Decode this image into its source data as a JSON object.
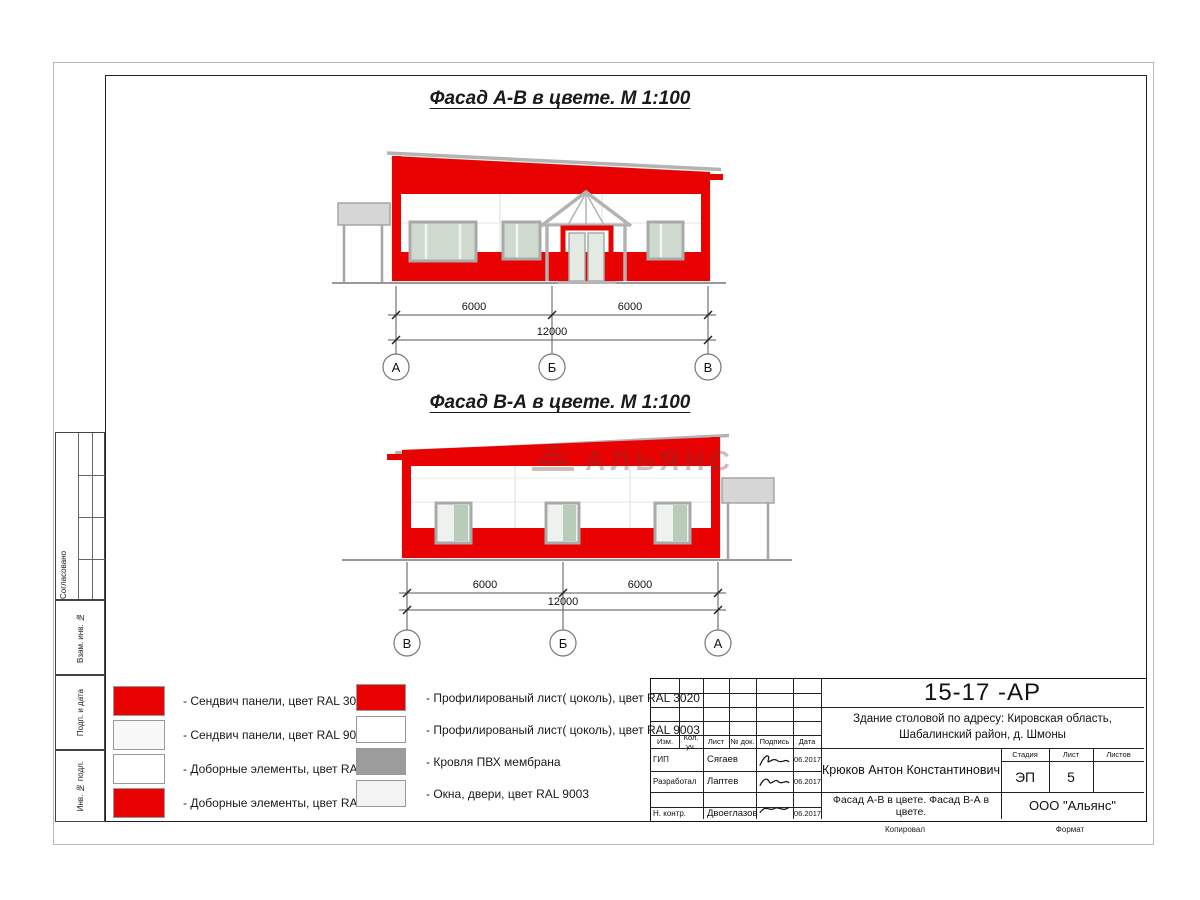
{
  "colors": {
    "ral3020": "#e80202",
    "ral9003": "#ffffff",
    "membrane": "#9c9c9c",
    "glass": "#cfdacf",
    "glass2": "#eef2ee",
    "glasstint": "#b9ccba",
    "framegray": "#a9a9a9",
    "canopy": "#d6d6d6"
  },
  "drawing": {
    "title_ab": "Фасад А-В в цвете.  М 1:100",
    "title_ba": "Фасад В-А в цвете.  М 1:100",
    "watermark": "АЛЬЯНС"
  },
  "facade_ab": {
    "dim_left": "6000",
    "dim_right": "6000",
    "dim_total": "12000",
    "axes": [
      "А",
      "Б",
      "В"
    ]
  },
  "facade_ba": {
    "dim_left": "6000",
    "dim_right": "6000",
    "dim_total": "12000",
    "axes": [
      "В",
      "Б",
      "А"
    ]
  },
  "legend": {
    "left": [
      {
        "color": "#e80202",
        "label": "- Сендвич панели, цвет RAL 3020"
      },
      {
        "color": "#f8f8f8",
        "label": "- Сендвич панели, цвет RAL 9003"
      },
      {
        "color": "#ffffff",
        "label": "- Доборные элементы, цвет RAL 9003"
      },
      {
        "color": "#e80202",
        "label": "- Доборные элементы, цвет RAL 3020"
      }
    ],
    "right": [
      {
        "color": "#e80202",
        "label": "- Профилированый лист( цоколь), цвет RAL 3020"
      },
      {
        "color": "#ffffff",
        "label": "- Профилированый лист( цоколь), цвет RAL 9003"
      },
      {
        "color": "#9c9c9c",
        "label": "- Кровля ПВХ мембрана"
      },
      {
        "color": "#f3f3f3",
        "label": "- Окна, двери, цвет RAL 9003"
      }
    ]
  },
  "titleblock": {
    "doc_number": "15-17 -АР",
    "object_line1": "Здание столовой по адресу: Кировская область,",
    "object_line2": "Шабалинский район, д. Шмоны",
    "header_cols": [
      "Изм.",
      "Кол. уч.",
      "Лист",
      "№ док.",
      "Подпись",
      "Дата"
    ],
    "rows": [
      {
        "role": "ГИП",
        "name": "Сягаев",
        "date": "06.2017"
      },
      {
        "role": "Разработал",
        "name": "Лаптев",
        "date": "06.2017"
      },
      {
        "role": "Н. контр.",
        "name": "Двоеглазов",
        "date": "06.2017"
      }
    ],
    "chief": "Крюков Антон Константинович",
    "stage_label": "Стадия",
    "sheet_label": "Лист",
    "sheets_label": "Листов",
    "stage": "ЭП",
    "sheet": "5",
    "sheets": "",
    "sheet_title": "Фасад А-В в цвете. Фасад В-А в цвете.",
    "company": "ООО \"Альянс\"",
    "copied_label": "Копировал",
    "format_label": "Формат"
  },
  "side_stamps": {
    "approve": "Согласовано",
    "vzam": "Взам. инв. №",
    "podp": "Подп. и дата",
    "inv": "Инв. № подл."
  }
}
